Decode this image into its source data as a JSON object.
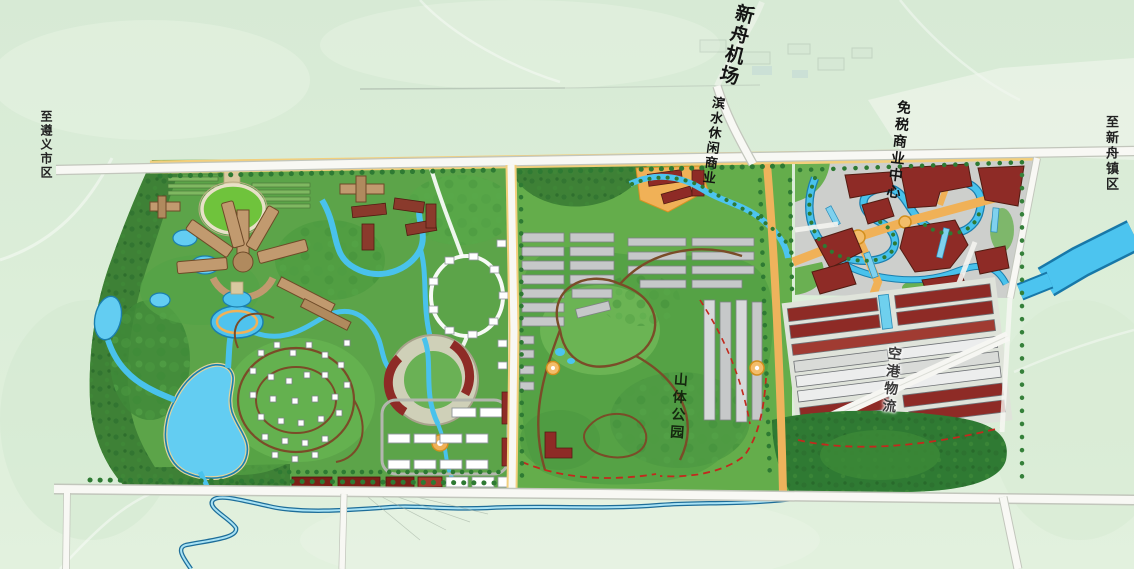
{
  "map": {
    "labels": [
      {
        "id": "airport",
        "text": "新舟机场"
      },
      {
        "id": "waterfront-commercial",
        "text": "滨水休闲商业"
      },
      {
        "id": "duty-free-center",
        "text": "免税商业中心"
      },
      {
        "id": "to-zunyi-city",
        "text": "至遵义市区"
      },
      {
        "id": "to-xinzhou-town",
        "text": "至新舟镇区"
      },
      {
        "id": "mountain-park",
        "text": "山体公园"
      },
      {
        "id": "air-logistics",
        "text": "空港物流"
      }
    ],
    "colors": {
      "background_mint": "#dcedd9",
      "park_green": "#5ca449",
      "forest_green": "#3e8136",
      "water_blue": "#4cc4ef",
      "building_maroon": "#8e2b26",
      "plaza_orange": "#f0b157",
      "road_white": "#f8f8f4",
      "boundary_red_dash": "#c2291d",
      "building_gray": "#c6c8c9",
      "resort_tan": "#c19a6f"
    }
  }
}
